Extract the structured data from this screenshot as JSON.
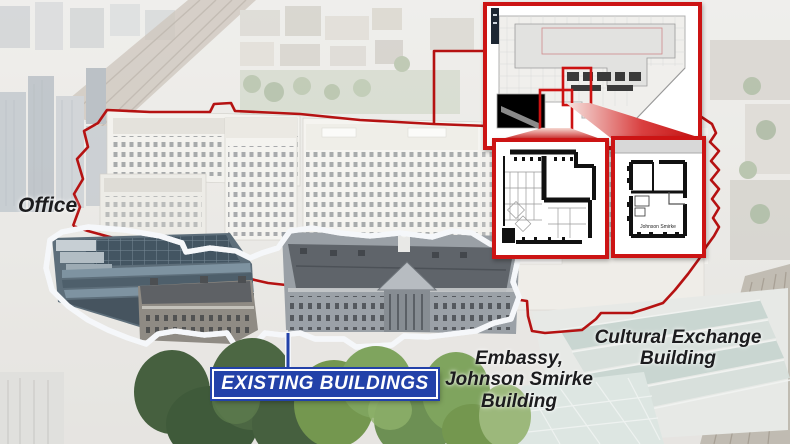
{
  "annotations": {
    "office": "Office",
    "existing_buildings": "EXISTING BUILDINGS",
    "embassy_line1": "Embassy,",
    "embassy_line2": "Johnson Smirke",
    "embassy_line3": "Building",
    "cultural_line1": "Cultural Exchange",
    "cultural_line2": "Building",
    "inset_plan_label": "Johnson Smirke"
  },
  "colors": {
    "site_outline_red": "#b51212",
    "inset_border_red": "#cc1414",
    "existing_outline_blue": "#1d3a8e",
    "outline_casing_white": "#f5f7fa",
    "label_box_blue": "#2342a9",
    "label_text_white": "#ffffff",
    "annotation_text": "#1c1c1e"
  }
}
